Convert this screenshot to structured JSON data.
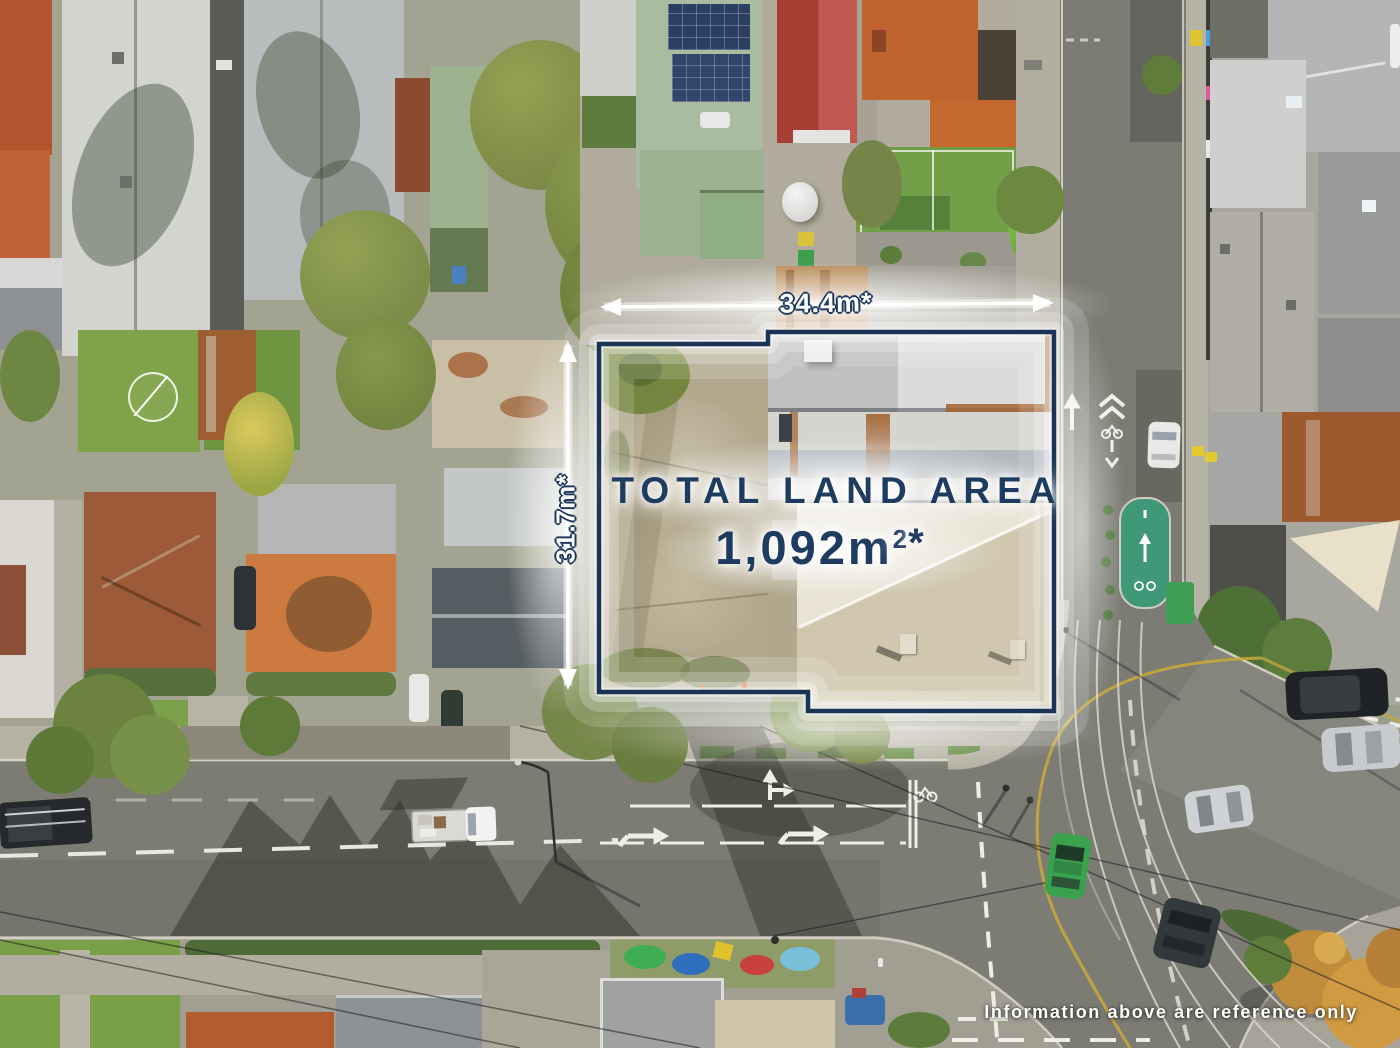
{
  "annotation": {
    "width_label": "34.4m*",
    "depth_label": "31.7m*",
    "area_title": "TOTAL LAND AREA",
    "area_value": "1,092m",
    "area_superscript": "2",
    "area_asterisk": "*",
    "disclaimer": "Information above are reference only",
    "colors": {
      "navy_text": "#1d3c60",
      "boundary_navy": "#1a3457",
      "glow_white": "#ffffff",
      "bike_lane_green": "#3f9878",
      "road_line_yellow": "#c8a73c"
    }
  }
}
